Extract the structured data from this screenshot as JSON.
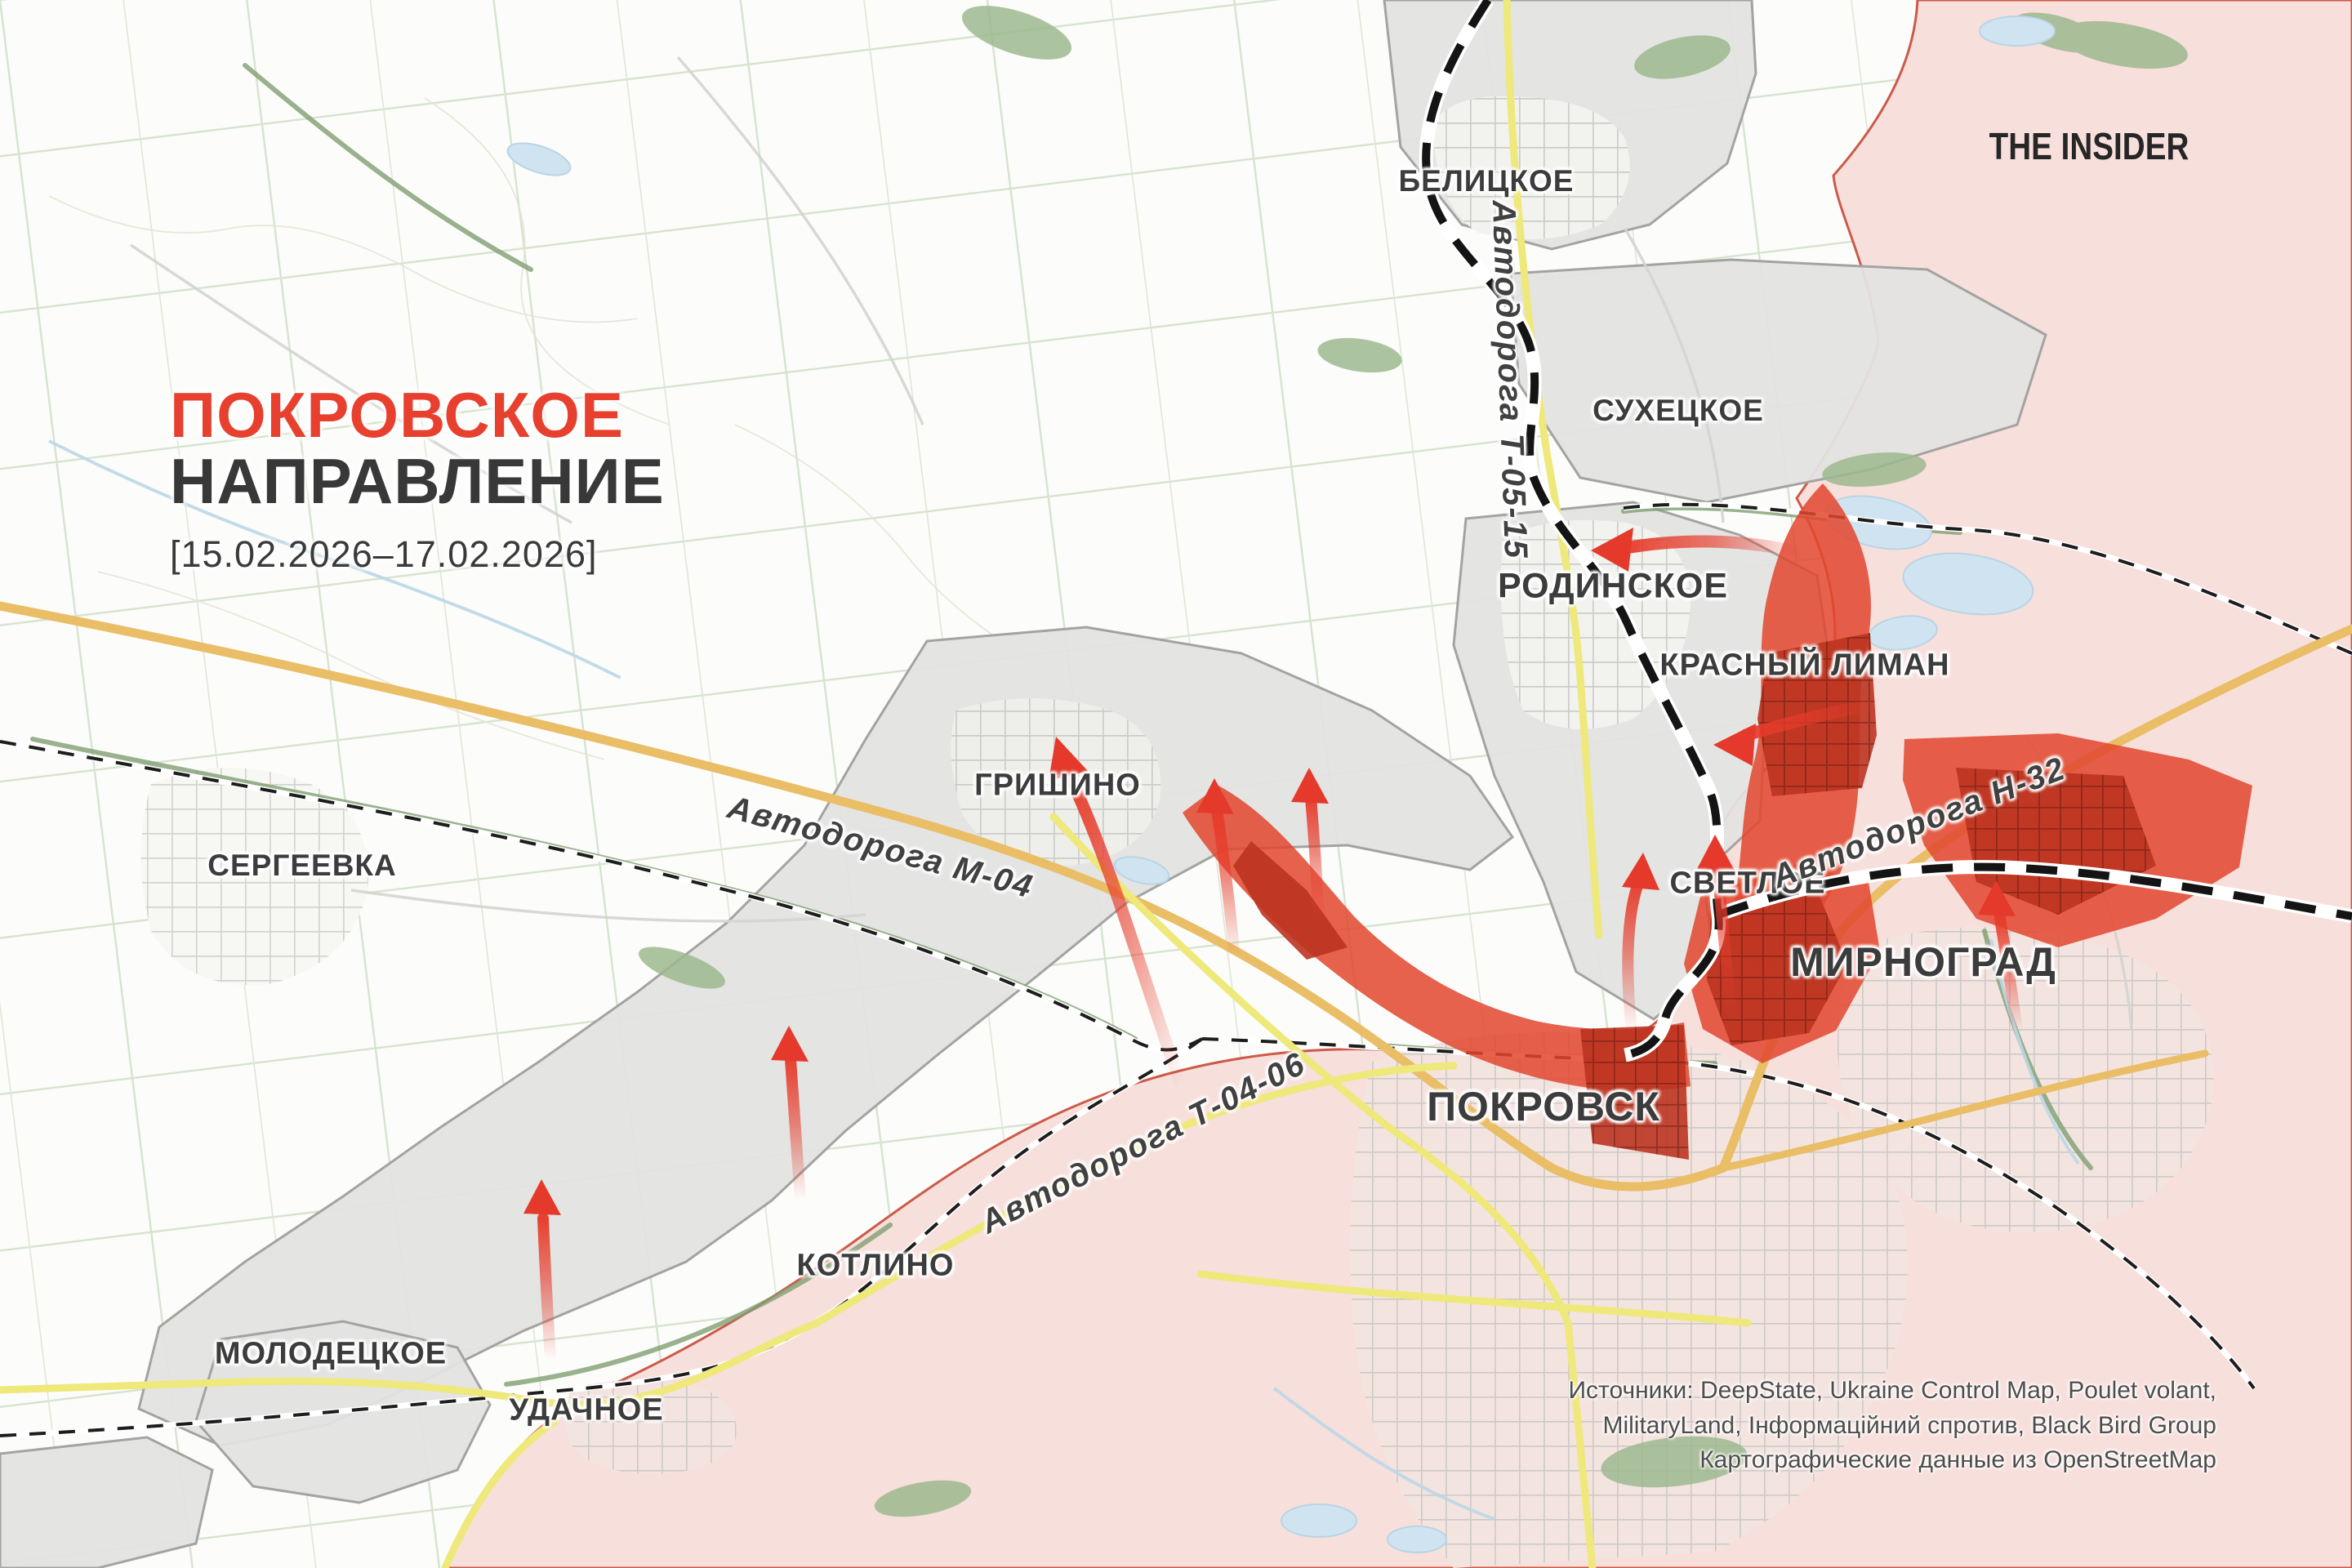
{
  "title": {
    "line1": "ПОКРОВСКОЕ",
    "line2": "НАПРАВЛЕНИЕ",
    "date_range": "[15.02.2026–17.02.2026]"
  },
  "branding": {
    "logo_text": "THE INSIDER"
  },
  "attribution": {
    "line1": "Источники: DeepState, Ukraine Control Map, Poulet volant,",
    "line2": "MilitaryLand, Інформаційний спротив, Black Bird Group",
    "line3": "Картографические данные из OpenStreetMap"
  },
  "settlements": [
    {
      "label": "БЕЛИЦКОЕ"
    },
    {
      "label": "СУХЕЦКОЕ"
    },
    {
      "label": "РОДИНСКОЕ"
    },
    {
      "label": "КРАСНЫЙ ЛИМАН"
    },
    {
      "label": "ГРИШИНО"
    },
    {
      "label": "СЕРГЕЕВКА"
    },
    {
      "label": "СВЕТЛОЕ"
    },
    {
      "label": "МИРНОГРАД"
    },
    {
      "label": "ПОКРОВСК"
    },
    {
      "label": "КОТЛИНО"
    },
    {
      "label": "МОЛОДЕЦКОЕ"
    },
    {
      "label": "УДАЧНОЕ"
    }
  ],
  "roads": [
    {
      "label": "Автодорога Т-05-15"
    },
    {
      "label": "Автодорога М-04"
    },
    {
      "label": "Автодорога Н-32"
    },
    {
      "label": "Автодорога Т-04-06"
    }
  ],
  "colors": {
    "title_accent": "#e8402e",
    "occupied_fill": "#f7dfdc",
    "occupied_border": "#c74a37",
    "contested_fill": "#e3e3e1",
    "advance_fill": "#e2472e",
    "arrow": "#e63b2a",
    "front_line": "#141414",
    "road_yellow": "#efe87b",
    "road_orange": "#e9be67"
  }
}
